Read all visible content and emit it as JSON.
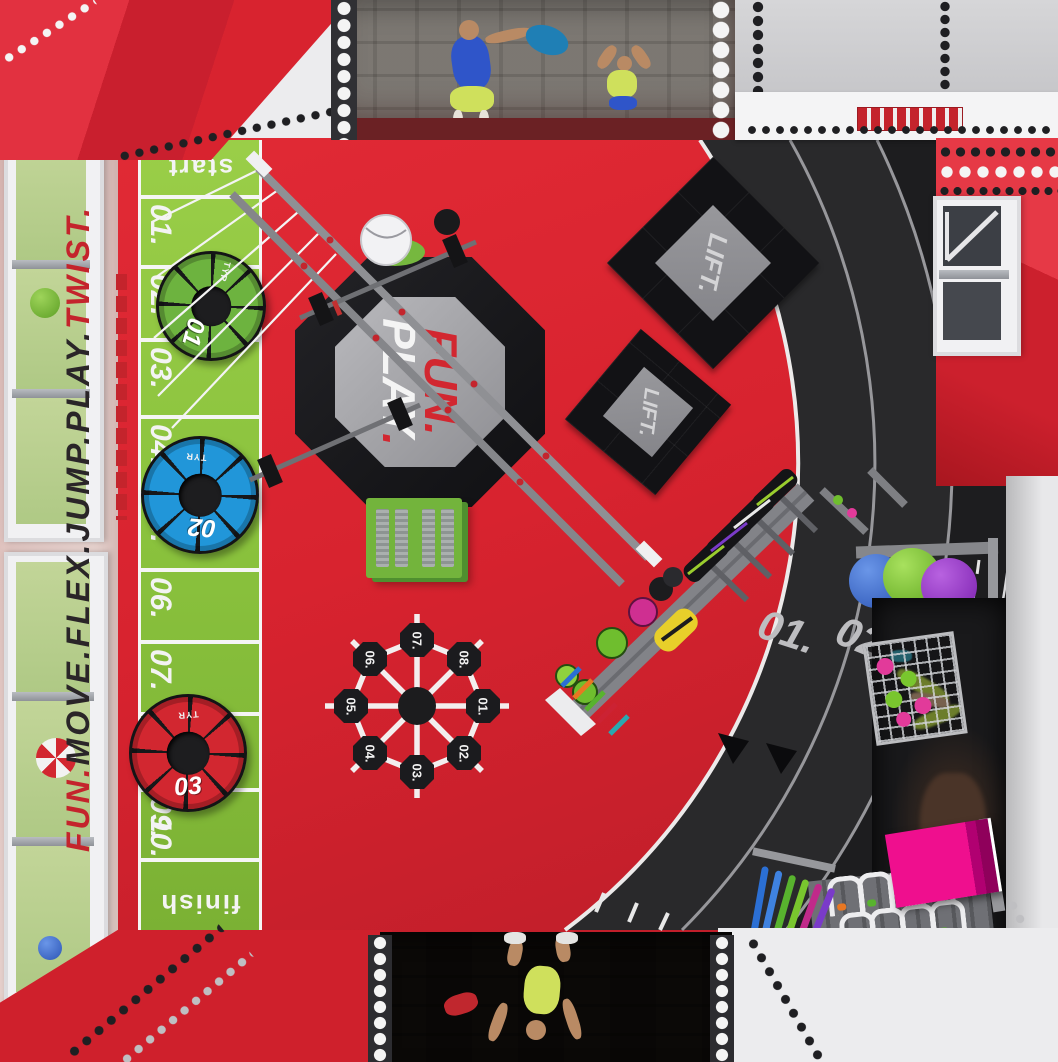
{
  "branding": {
    "left_wall": {
      "part1": "FUN.",
      "part2": "MOVE.FLEX.JUMP.PLAY.",
      "part3": "TWIST."
    },
    "octagon": {
      "line1": "FUN.",
      "line2": "PLAY",
      "line2_dot": "."
    }
  },
  "sprint_track": {
    "start": "start",
    "finish": "finish",
    "numbers": [
      "01.",
      "02.",
      "03.",
      "04.",
      "05.",
      "06.",
      "07.",
      "08.",
      "09.",
      "10."
    ]
  },
  "tires": [
    {
      "number": "01",
      "brand": "TYR"
    },
    {
      "number": "02",
      "brand": "TYR"
    },
    {
      "number": "03",
      "brand": "TYR"
    }
  ],
  "lift_mat": {
    "label": "LIFT."
  },
  "running_track": {
    "lanes": [
      "01.",
      "02."
    ]
  },
  "agility_wheel": {
    "numbers": [
      "01.",
      "02.",
      "03.",
      "04.",
      "05.",
      "06.",
      "07.",
      "08."
    ]
  },
  "colors": {
    "floor_red": "#d8232f",
    "track_green": "#8ac23d",
    "floor_black": "#28282a",
    "accent_red": "#c4242c",
    "magenta": "#e6007e"
  }
}
